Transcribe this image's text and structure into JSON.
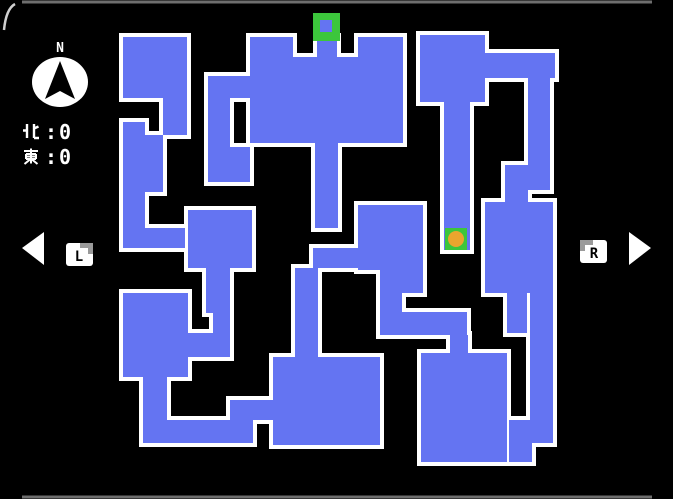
{
  "colors": {
    "bg": "#000000",
    "floor": "#6474F2",
    "wall": "#FFFFFF",
    "marker_green": "#3CC63C",
    "marker_orange": "#EAA52E",
    "frame_line": "#6E6E6E",
    "corner_arc": "#CFCFCF",
    "button_face": "#FFFFFF",
    "button_shade": "#9A9A9A"
  },
  "compass": {
    "label": "N"
  },
  "stats": [
    {
      "label": "北",
      "separator": ":",
      "value": "0"
    },
    {
      "label": "東",
      "separator": ":",
      "value": "0"
    }
  ],
  "nav": {
    "left_button": "L",
    "right_button": "R"
  },
  "maze": {
    "wall_thickness": 4,
    "rects": [
      [
        123,
        37,
        64,
        61
      ],
      [
        163,
        98,
        24,
        37
      ],
      [
        123,
        122,
        22,
        126
      ],
      [
        145,
        135,
        18,
        57
      ],
      [
        123,
        228,
        62,
        20
      ],
      [
        213,
        76,
        37,
        22
      ],
      [
        208,
        76,
        22,
        106
      ],
      [
        230,
        147,
        20,
        35
      ],
      [
        188,
        210,
        64,
        58
      ],
      [
        206,
        268,
        24,
        45
      ],
      [
        213,
        313,
        17,
        20
      ],
      [
        188,
        333,
        42,
        24
      ],
      [
        123,
        293,
        65,
        84
      ],
      [
        143,
        377,
        24,
        66
      ],
      [
        143,
        420,
        110,
        23
      ],
      [
        230,
        400,
        23,
        43
      ],
      [
        230,
        400,
        43,
        20
      ],
      [
        250,
        37,
        43,
        106
      ],
      [
        317,
        37,
        20,
        106
      ],
      [
        358,
        37,
        45,
        106
      ],
      [
        250,
        57,
        153,
        86
      ],
      [
        315,
        143,
        23,
        85
      ],
      [
        313,
        248,
        45,
        20
      ],
      [
        295,
        268,
        23,
        24
      ],
      [
        295,
        292,
        23,
        65
      ],
      [
        358,
        205,
        65,
        65
      ],
      [
        380,
        270,
        43,
        23
      ],
      [
        380,
        293,
        22,
        42
      ],
      [
        402,
        312,
        65,
        23
      ],
      [
        450,
        335,
        18,
        22
      ],
      [
        273,
        357,
        107,
        88
      ],
      [
        421,
        353,
        86,
        109
      ],
      [
        420,
        35,
        65,
        67
      ],
      [
        444,
        102,
        26,
        148
      ],
      [
        485,
        53,
        70,
        25
      ],
      [
        528,
        78,
        22,
        112
      ],
      [
        505,
        165,
        23,
        40
      ],
      [
        485,
        202,
        68,
        91
      ],
      [
        507,
        293,
        20,
        40
      ],
      [
        530,
        293,
        23,
        150
      ],
      [
        509,
        420,
        23,
        42
      ]
    ]
  },
  "markers": {
    "entrance": {
      "x": 313,
      "y": 13,
      "size": 27,
      "hole": {
        "x": 320,
        "y": 20,
        "w": 12,
        "h": 12
      }
    },
    "player": {
      "x": 445,
      "y": 228,
      "size": 22,
      "dot": {
        "cx": 456,
        "cy": 239,
        "r": 8
      }
    }
  }
}
